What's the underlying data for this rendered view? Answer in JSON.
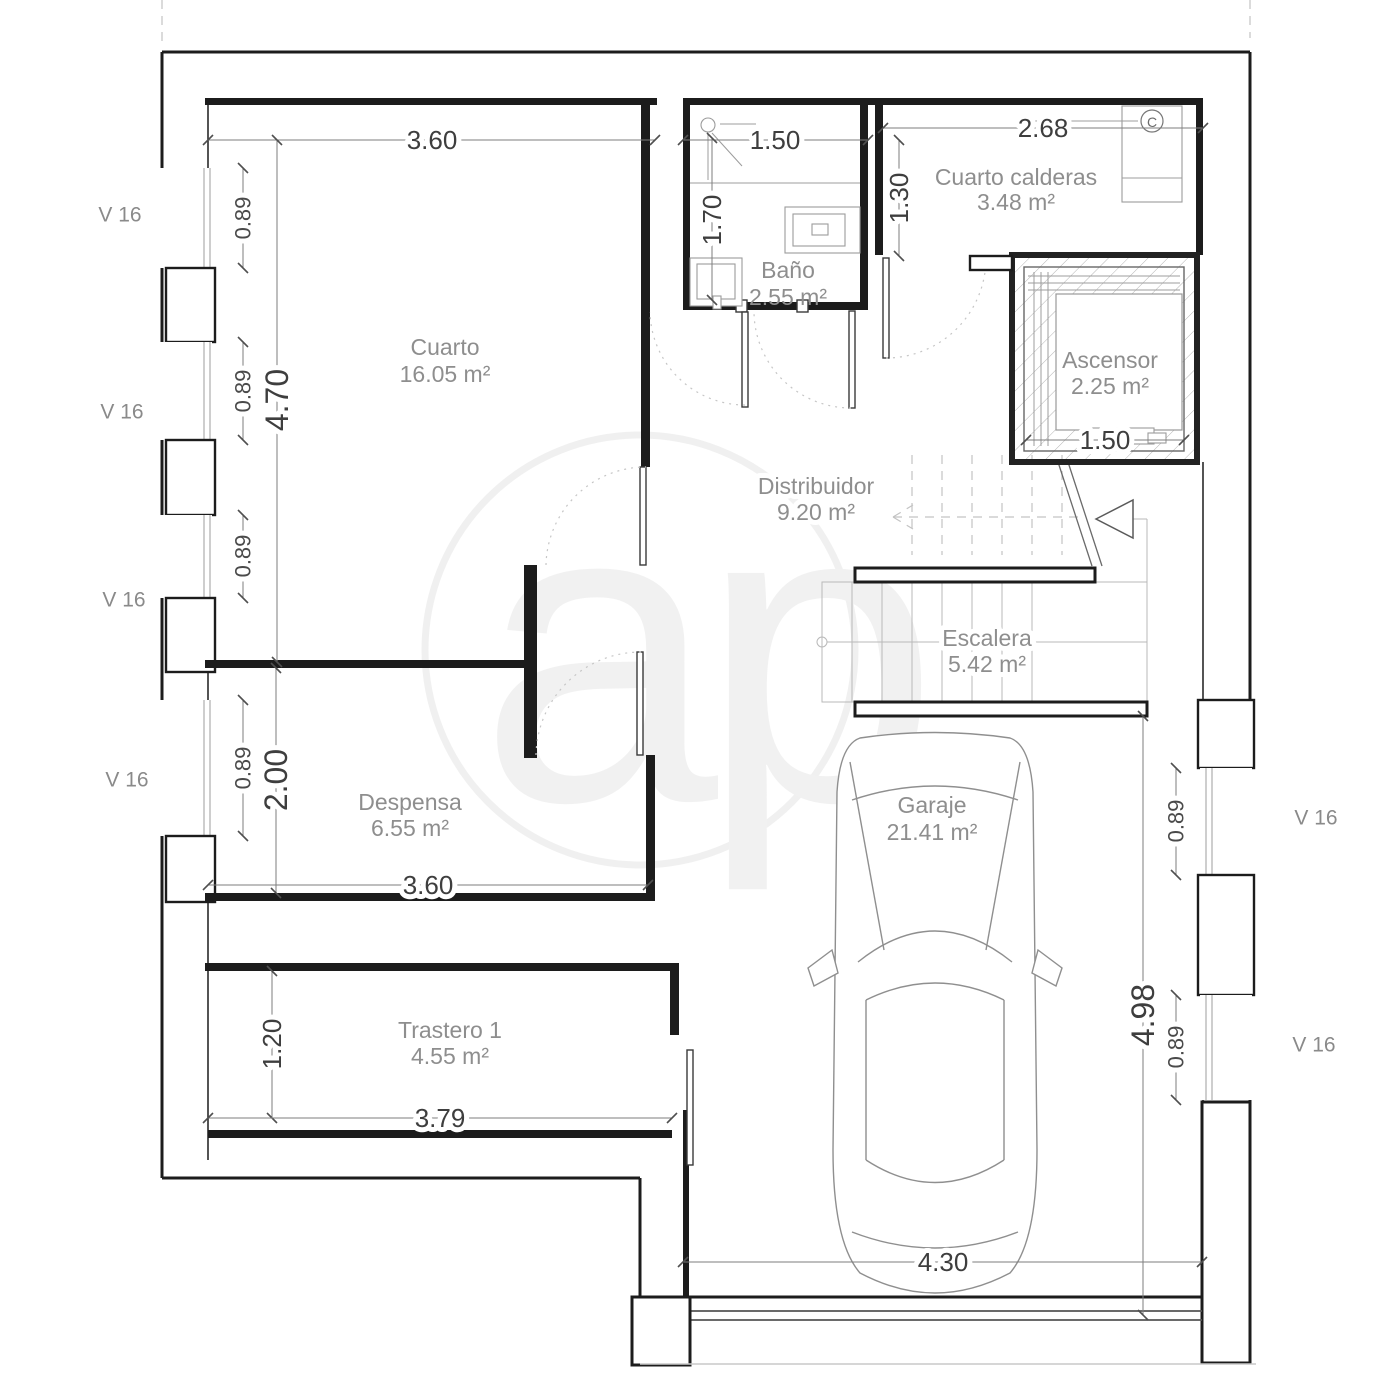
{
  "watermark": {
    "text": "ap"
  },
  "rooms": {
    "cuarto": {
      "name": "Cuarto",
      "area": "16.05 m²"
    },
    "bano": {
      "name": "Baño",
      "area": "2.55 m²"
    },
    "calderas": {
      "name": "Cuarto calderas",
      "area": "3.48 m²"
    },
    "ascensor": {
      "name": "Ascensor",
      "area": "2.25 m²"
    },
    "distribuidor": {
      "name": "Distribuidor",
      "area": "9.20 m²"
    },
    "escalera": {
      "name": "Escalera",
      "area": "5.42 m²"
    },
    "despensa": {
      "name": "Despensa",
      "area": "6.55 m²"
    },
    "trastero": {
      "name": "Trastero 1",
      "area": "4.55 m²"
    },
    "garaje": {
      "name": "Garaje",
      "area": "21.41 m²"
    }
  },
  "dims": {
    "cuarto_w": "3.60",
    "cuarto_h": "4.70",
    "bano_w": "1.50",
    "bano_h": "1.70",
    "calderas_w": "2.68",
    "hall_top_h": "1.30",
    "ascensor_w": "1.50",
    "despensa_h": "2.00",
    "despensa_w": "3.60",
    "trastero_h": "1.20",
    "trastero_w": "3.79",
    "garaje_w": "4.30",
    "garaje_h": "4.98",
    "window_w": "0.89"
  },
  "labels": {
    "window": "V 16",
    "boiler": "C"
  },
  "colors": {
    "wall": "#1c1c1c",
    "dim_text": "#3e3e3e",
    "room_text": "#8e8e8e",
    "light_line": "#b9b9b9",
    "watermark": "#ededed"
  },
  "icons": [
    "car-icon",
    "shower-icon",
    "sink-icon",
    "toilet-icon",
    "boiler-icon",
    "elevator-shaft",
    "staircase",
    "stair-direction-arrow"
  ]
}
